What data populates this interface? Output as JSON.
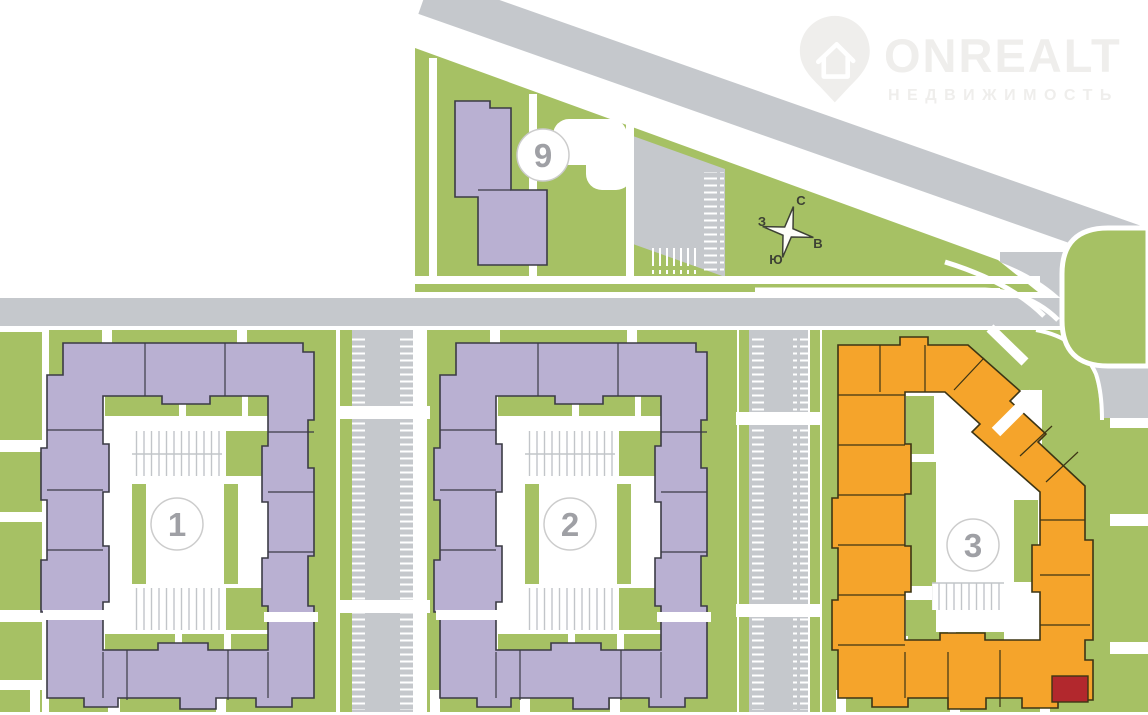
{
  "watermark": {
    "brand": "ONREALT",
    "tagline": "НЕДВИЖИМОСТЬ"
  },
  "compass": {
    "n": "С",
    "s": "Ю",
    "w": "З",
    "e": "В"
  },
  "markers": {
    "b1": "1",
    "b2": "2",
    "b3": "3",
    "b9": "9"
  },
  "colors": {
    "green": "#a6c164",
    "road": "#c5c8cc",
    "purple": "#b9b0d2",
    "purple-line": "#3b3b45",
    "orange": "#f5a42b",
    "orange-line": "#3d3514",
    "red": "#b2282d",
    "circle-border": "#cccccc",
    "circle-text": "#9fa0a5",
    "tick": "#c2c5c9",
    "compass-ink": "#3d4134",
    "watermark-ink": "#efeeec",
    "white": "#ffffff"
  }
}
